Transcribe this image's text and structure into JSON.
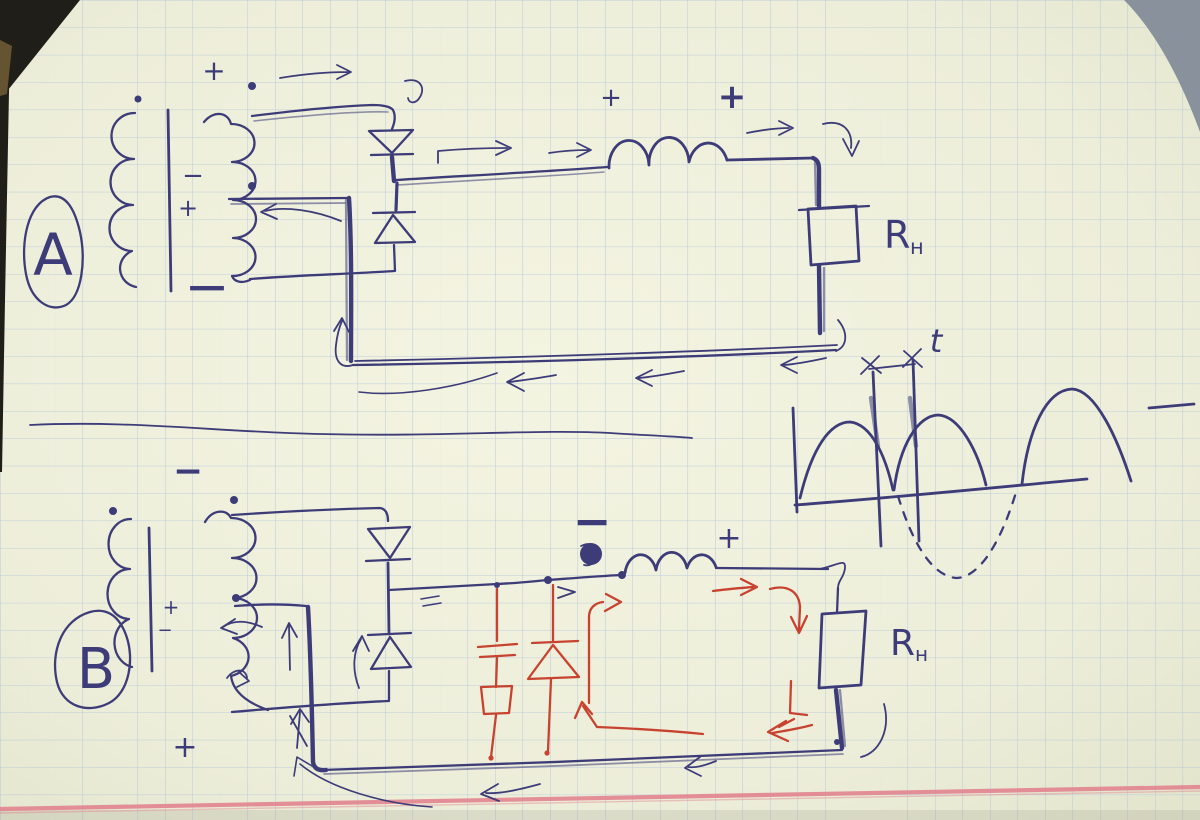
{
  "photo": {
    "paper_color": "#edeeda",
    "paper_center_color": "#f3f4e1",
    "grid_color": "#b2c3da",
    "ink_blue": "#3d3c78",
    "ink_red": "#c8432f",
    "margin_line_color": "#e2838f",
    "corner_shadow_color": "#1f1e19",
    "corner_gray_color": "#89919c",
    "edge_brown_color": "#6d5a35"
  },
  "signs": {
    "plus": "+",
    "minus": "−"
  },
  "circuit_a": {
    "label": "A",
    "load_label": {
      "base": "R",
      "sub": "н"
    }
  },
  "circuit_b": {
    "label": "B",
    "load_label": {
      "base": "R",
      "sub": "н"
    }
  },
  "waveform": {
    "time_label": "t"
  }
}
